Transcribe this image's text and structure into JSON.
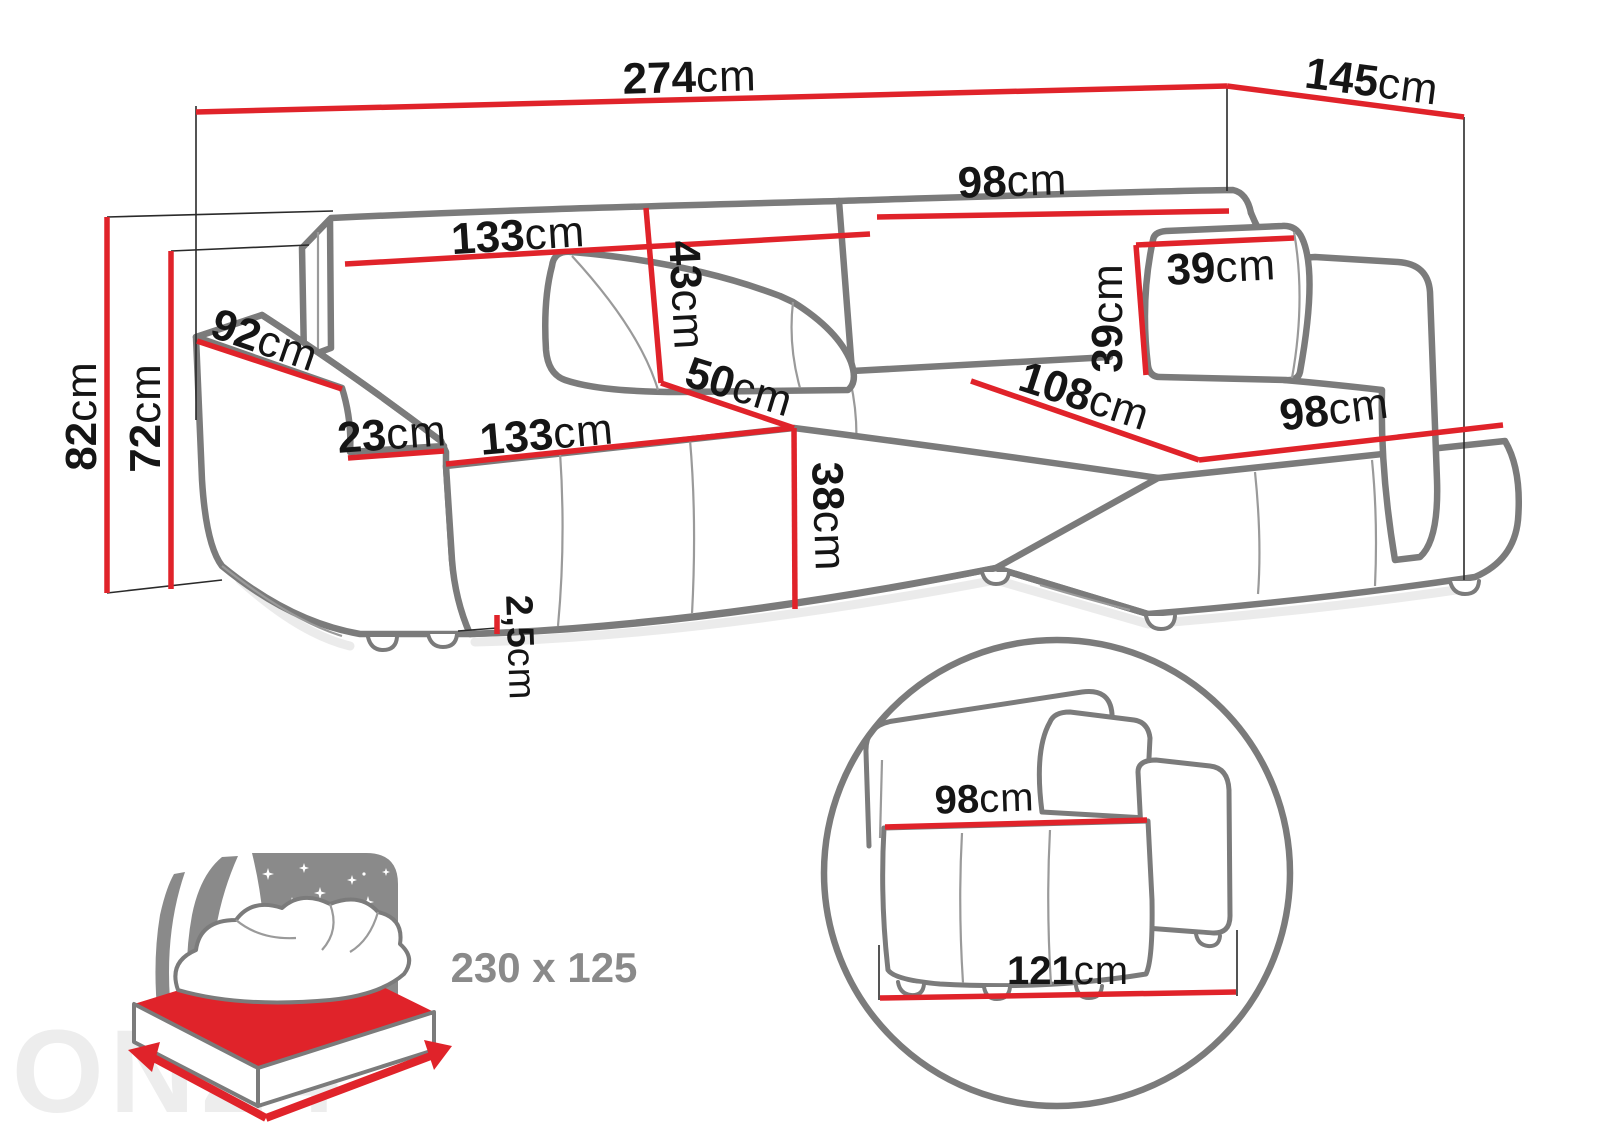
{
  "dims": {
    "back_width": {
      "value": "274",
      "unit": "cm"
    },
    "side_depth": {
      "value": "145",
      "unit": "cm"
    },
    "total_height": {
      "value": "82",
      "unit": "cm"
    },
    "backrest_height": {
      "value": "72",
      "unit": "cm"
    },
    "armrest_length": {
      "value": "92",
      "unit": "cm"
    },
    "backrest_cushion_width": {
      "value": "133",
      "unit": "cm"
    },
    "backrest_cushion_height": {
      "value": "43",
      "unit": "cm"
    },
    "backrest_right_width": {
      "value": "98",
      "unit": "cm"
    },
    "pillow_width": {
      "value": "39",
      "unit": "cm"
    },
    "pillow_height": {
      "value": "39",
      "unit": "cm"
    },
    "seat_diagonal_depth": {
      "value": "50",
      "unit": "cm"
    },
    "armrest_width": {
      "value": "23",
      "unit": "cm"
    },
    "seat_width": {
      "value": "133",
      "unit": "cm"
    },
    "seat_height": {
      "value": "38",
      "unit": "cm"
    },
    "leg_height": {
      "value": "2,5",
      "unit": "cm"
    },
    "chaise_diagonal_length": {
      "value": "108",
      "unit": "cm"
    },
    "chaise_width": {
      "value": "98",
      "unit": "cm"
    }
  },
  "inset": {
    "seat_width": {
      "value": "98",
      "unit": "cm"
    },
    "base_width": {
      "value": "121",
      "unit": "cm"
    }
  },
  "bed": {
    "size_label": "230 x 125"
  },
  "watermark": {
    "text": "ON24"
  },
  "colors": {
    "dimension_red": "#e0232a",
    "outline_gray": "#7b7b7b",
    "label_black": "#151515",
    "icon_gray": "#8a8a8a",
    "watermark_gray": "#ededed"
  }
}
